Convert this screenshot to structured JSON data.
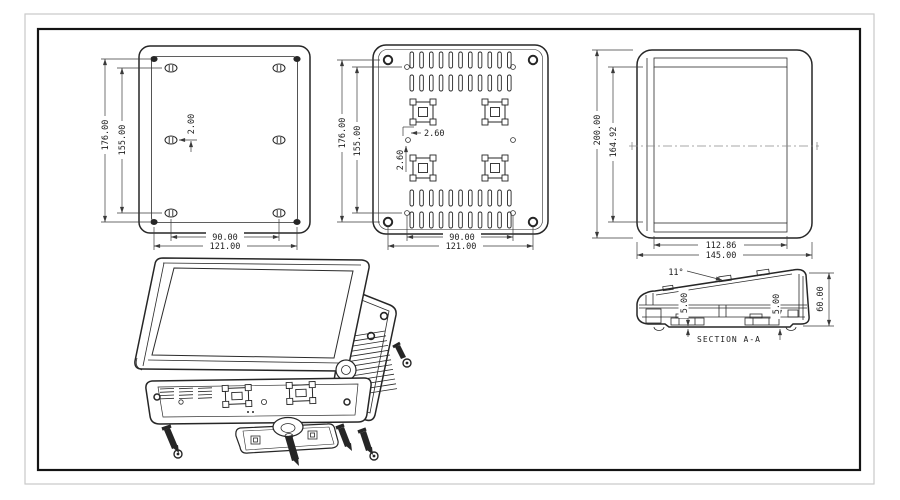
{
  "colors": {
    "background": "#ffffff",
    "line": "#262626",
    "dimension_line": "#3a3a3a",
    "border_inner": "#141414",
    "border_outer": "#c9c9c9"
  },
  "views": {
    "front": {
      "dim_height_outer": "176.00",
      "dim_height_inner": "155.00",
      "dim_offset": "2.00",
      "dim_width_inner": "90.00",
      "dim_width_outer": "121.00"
    },
    "back": {
      "dim_height_outer": "176.00",
      "dim_height_inner": "155.00",
      "dim_offset_h": "2.60",
      "dim_offset_v": "2.60",
      "dim_width_inner": "90.00",
      "dim_width_outer": "121.00"
    },
    "side": {
      "dim_height_outer": "200.00",
      "dim_height_inner": "164.92",
      "dim_depth_inner": "112.86",
      "dim_depth_outer": "145.00"
    },
    "section": {
      "label": "SECTION A-A",
      "dim_angle": "11°",
      "dim_front": "5.00",
      "dim_back": "5.00",
      "dim_height": "60.00"
    }
  }
}
